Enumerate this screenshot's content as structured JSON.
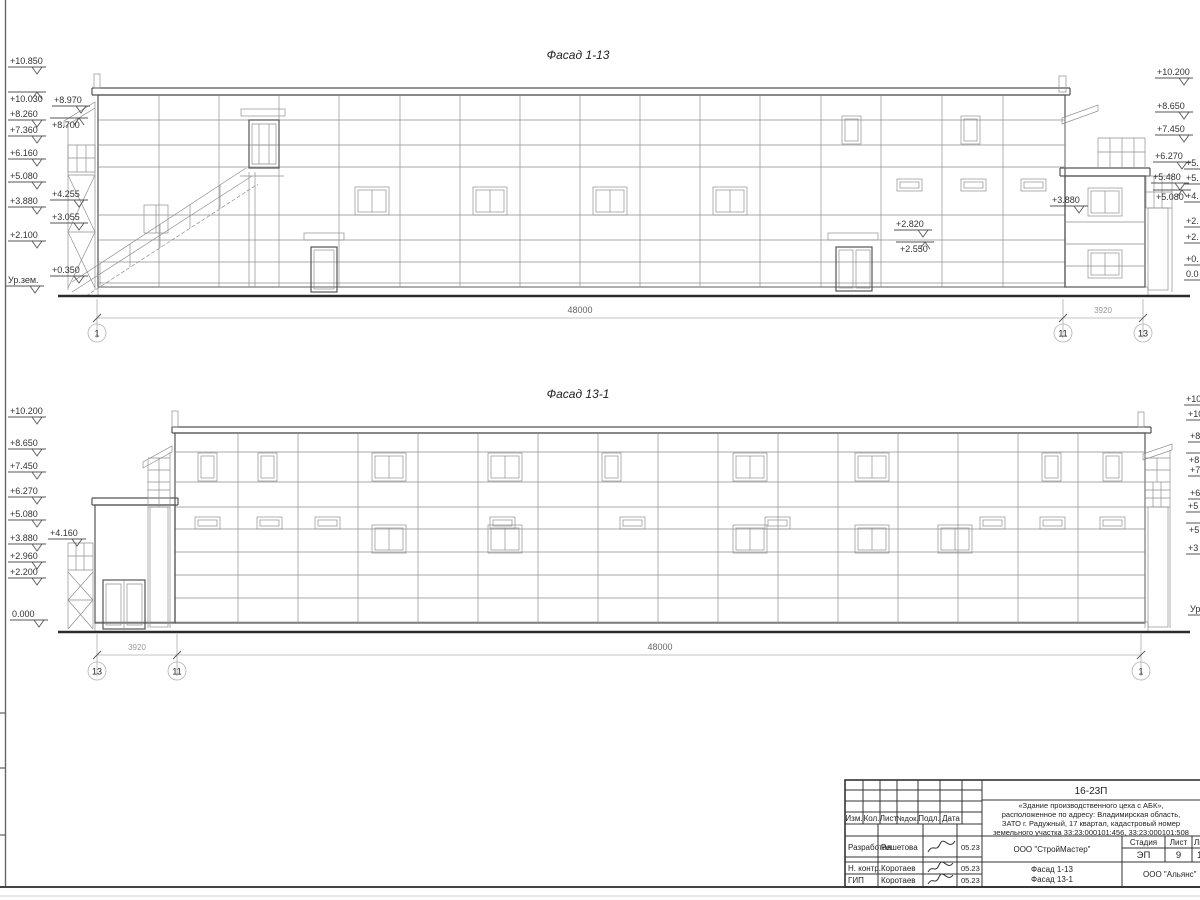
{
  "sheet": {
    "f1": {
      "title": "Фасад 1-13",
      "marks_left": [
        "+10.850",
        "+10.030",
        "+8.970",
        "+8.260",
        "+8.700",
        "+7.360",
        "+6.160",
        "+5.080",
        "+4.255",
        "+3.880",
        "+3.055",
        "+2.100",
        "+0.350",
        "Ур.зем."
      ],
      "marks_right": [
        "+10.200",
        "+8.650",
        "+7.450",
        "+6.270",
        "+5.480",
        "+5.080"
      ],
      "marks_right_cut": [
        "+5.",
        "+5.",
        "+4.",
        "+2.",
        "+2.",
        "+0.",
        "0.0"
      ],
      "marks_inner": [
        "+3.880",
        "+2.820",
        "+2.550"
      ],
      "dim_main": "48000",
      "dim_side": "3920",
      "axes": [
        "1",
        "11",
        "13"
      ]
    },
    "f2": {
      "title": "Фасад 13-1",
      "marks_left": [
        "+10.200",
        "+8.650",
        "+7.450",
        "+6.270",
        "+5.080",
        "+4.160",
        "+3.880",
        "+2.960",
        "+2.200",
        "0.000"
      ],
      "marks_right_cut": [
        "+10",
        "+10",
        "+8",
        "+8",
        "+7",
        "+6",
        "+5",
        "+5",
        "+3",
        "Ур"
      ],
      "dim_main": "48000",
      "dim_side": "3920",
      "axes": [
        "13",
        "11",
        "1"
      ]
    },
    "stamp": {
      "code": "16-23П",
      "project_lines": [
        "«Здание производственного цеха с АБК»,",
        "расположенное по адресу: Владимирская область,",
        "ЗАТО г. Радужный, 17 квартал, кадастровый номер",
        "земельного участка 33:23:000101:456, 33:23:000101:508"
      ],
      "cols": {
        "izm": "Изм.",
        "kol": "Кол.",
        "list": "Лист",
        "ndok": "№док.",
        "podp": "Подл.",
        "data": "Дата"
      },
      "rows": [
        {
          "role": "Разработал",
          "name": "Решетова",
          "date": "05.23"
        },
        {
          "role": "Н. контр.",
          "name": "Коротаев",
          "date": "05.23"
        },
        {
          "role": "ГИП",
          "name": "Коротаев",
          "date": "05.23"
        }
      ],
      "org": "ООО \"СтройМастер\"",
      "stage_label": "Стадия",
      "sheet_label": "Лист",
      "sheets_label": "Листов",
      "stage": "ЭП",
      "sheet_no": "9",
      "sheets_total": "1",
      "drawing_name1": "Фасад 1-13",
      "drawing_name2": "Фасад 13-1",
      "contractor": "ООО \"Альянс\""
    }
  }
}
